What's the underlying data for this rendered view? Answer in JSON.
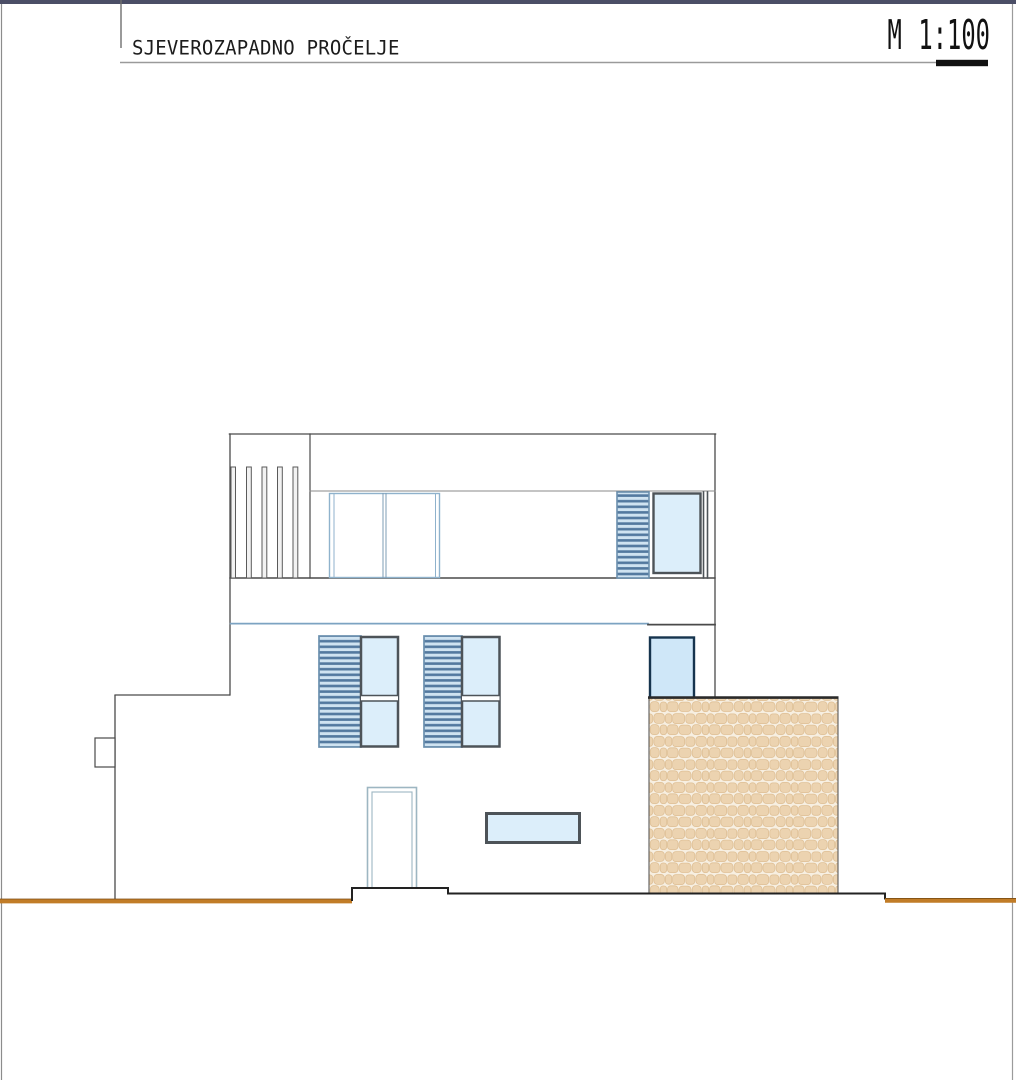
{
  "header": {
    "title": "SJEVEROZAPADNO PROČELJE",
    "scale": "M 1:100"
  },
  "drawing": {
    "type": "architectural-elevation",
    "legend_icons": [
      "louver-shutter-icon",
      "glazed-window-icon",
      "stone-wall-hatch-icon",
      "ground-line-icon"
    ]
  },
  "colors": {
    "top_band": "#4b4e66",
    "line_dark": "#4a4a4a",
    "line_black": "#1f1f1f",
    "line_gray": "#9a9a9a",
    "frame_blue_light": "#8fb2cc",
    "frame_dark": "#4d5358",
    "glass_fill": "#dceefa",
    "shutter_bg": "#cfe3f1",
    "shutter_slat": "#53799f",
    "corner_window_fill": "#cfe7f8",
    "corner_window_frame": "#16344e",
    "stone_fill": "#ecd3b0",
    "stone_mortar": "#f7efe1",
    "stone_edge": "#dfc096",
    "ground_orange": "#c17c27",
    "ground_orange_dark": "#7d4e14"
  }
}
